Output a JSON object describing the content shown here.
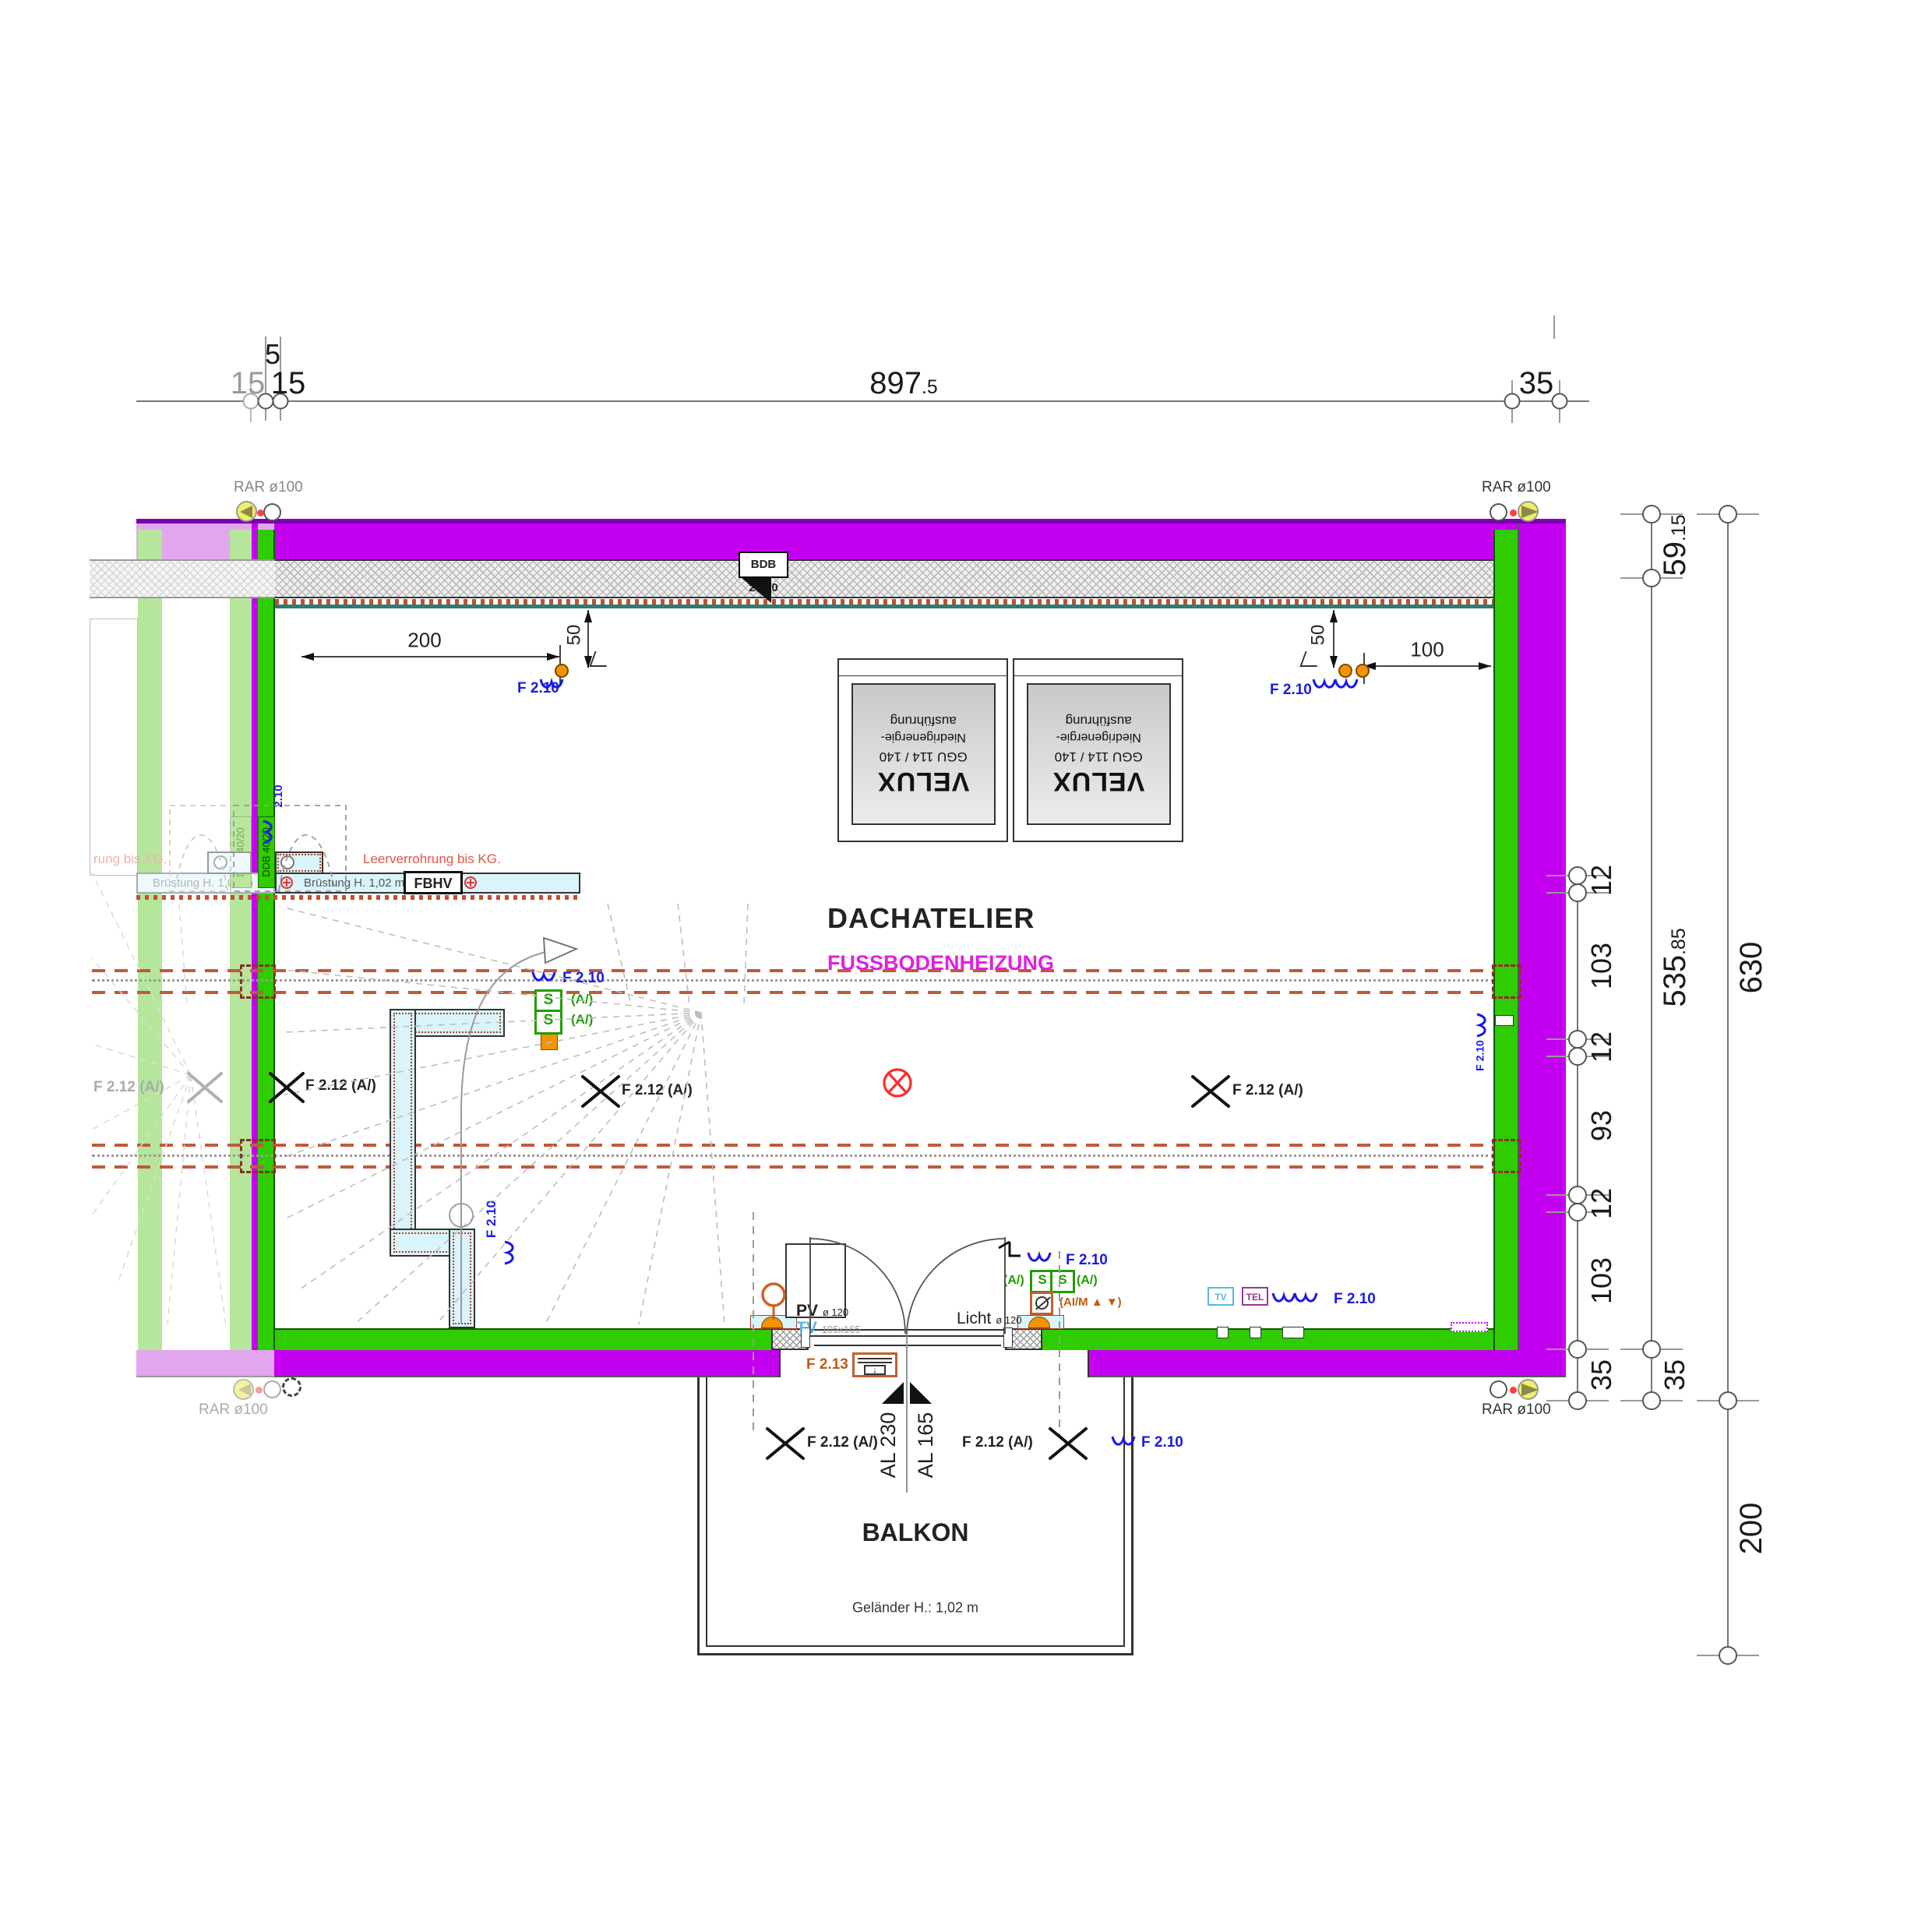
{
  "colors": {
    "magenta": "#c400f0",
    "magenta_dark": "#7a00b0",
    "lavender": "#e2a6ef",
    "green": "#2ecc00",
    "green_faded": "#b5e69b",
    "cyan_wall": "#d9f4fa",
    "teal": "#2a7d74",
    "pipe_red": "#c05a3a",
    "orange": "#f59300",
    "blue": "#1a1ae6",
    "signal_red": "#ff2a2a",
    "tv_cyan": "#55bbdd",
    "tel_purple": "#993399",
    "heating_text": "#e020e0",
    "rar_yellow": "#f2ee66"
  },
  "top_dim": {
    "v5": "5",
    "v15f": "15",
    "v15": "15",
    "v897": "897",
    "v897d": ".5",
    "v35": "35"
  },
  "right_dim": {
    "v59": "59",
    "v59d": ".15",
    "v535": "535",
    "v535d": ".85",
    "v630": "630",
    "v200": "200",
    "v35": "35",
    "v12": "12",
    "v103": "103",
    "v93": "93"
  },
  "inner_dim": {
    "v200": "200",
    "v50": "50",
    "v100": "100"
  },
  "rooms": {
    "main": "DACHATELIER",
    "heating": "FUSSBODENHEIZUNG",
    "balcony": "BALKON"
  },
  "velux": {
    "l1": "VELUX",
    "l2": "GGU 114 / 140",
    "l3": "Niedrigenergie-",
    "l4": "ausführung"
  },
  "labels": {
    "rar": "RAR ø100",
    "bdb": "BDB 20/20",
    "ddb": "DDB 40/20",
    "bruestung": "Brüstung H.  1,02 m",
    "fbhv": "FBHV",
    "leer": "Leerverrohrung bis KG.",
    "leer_cut": "rung bis KG.",
    "gelaender": "Geländer H.: 1,02 m",
    "al165": "AL 165",
    "al230": "AL 230",
    "f210": "F 2.10",
    "f210s": "2.10",
    "f212": "F 2.12 (A/)",
    "f213": "F 2.13",
    "s": "S",
    "av": "(A/)",
    "aim": "(AI/M ▲ ▼)",
    "pv": "PV",
    "pvd": "ø 120",
    "tv": "TV",
    "tvs": "105x165",
    "licht": "Licht",
    "lichtd": "ø 120",
    "tel": "TEL"
  }
}
